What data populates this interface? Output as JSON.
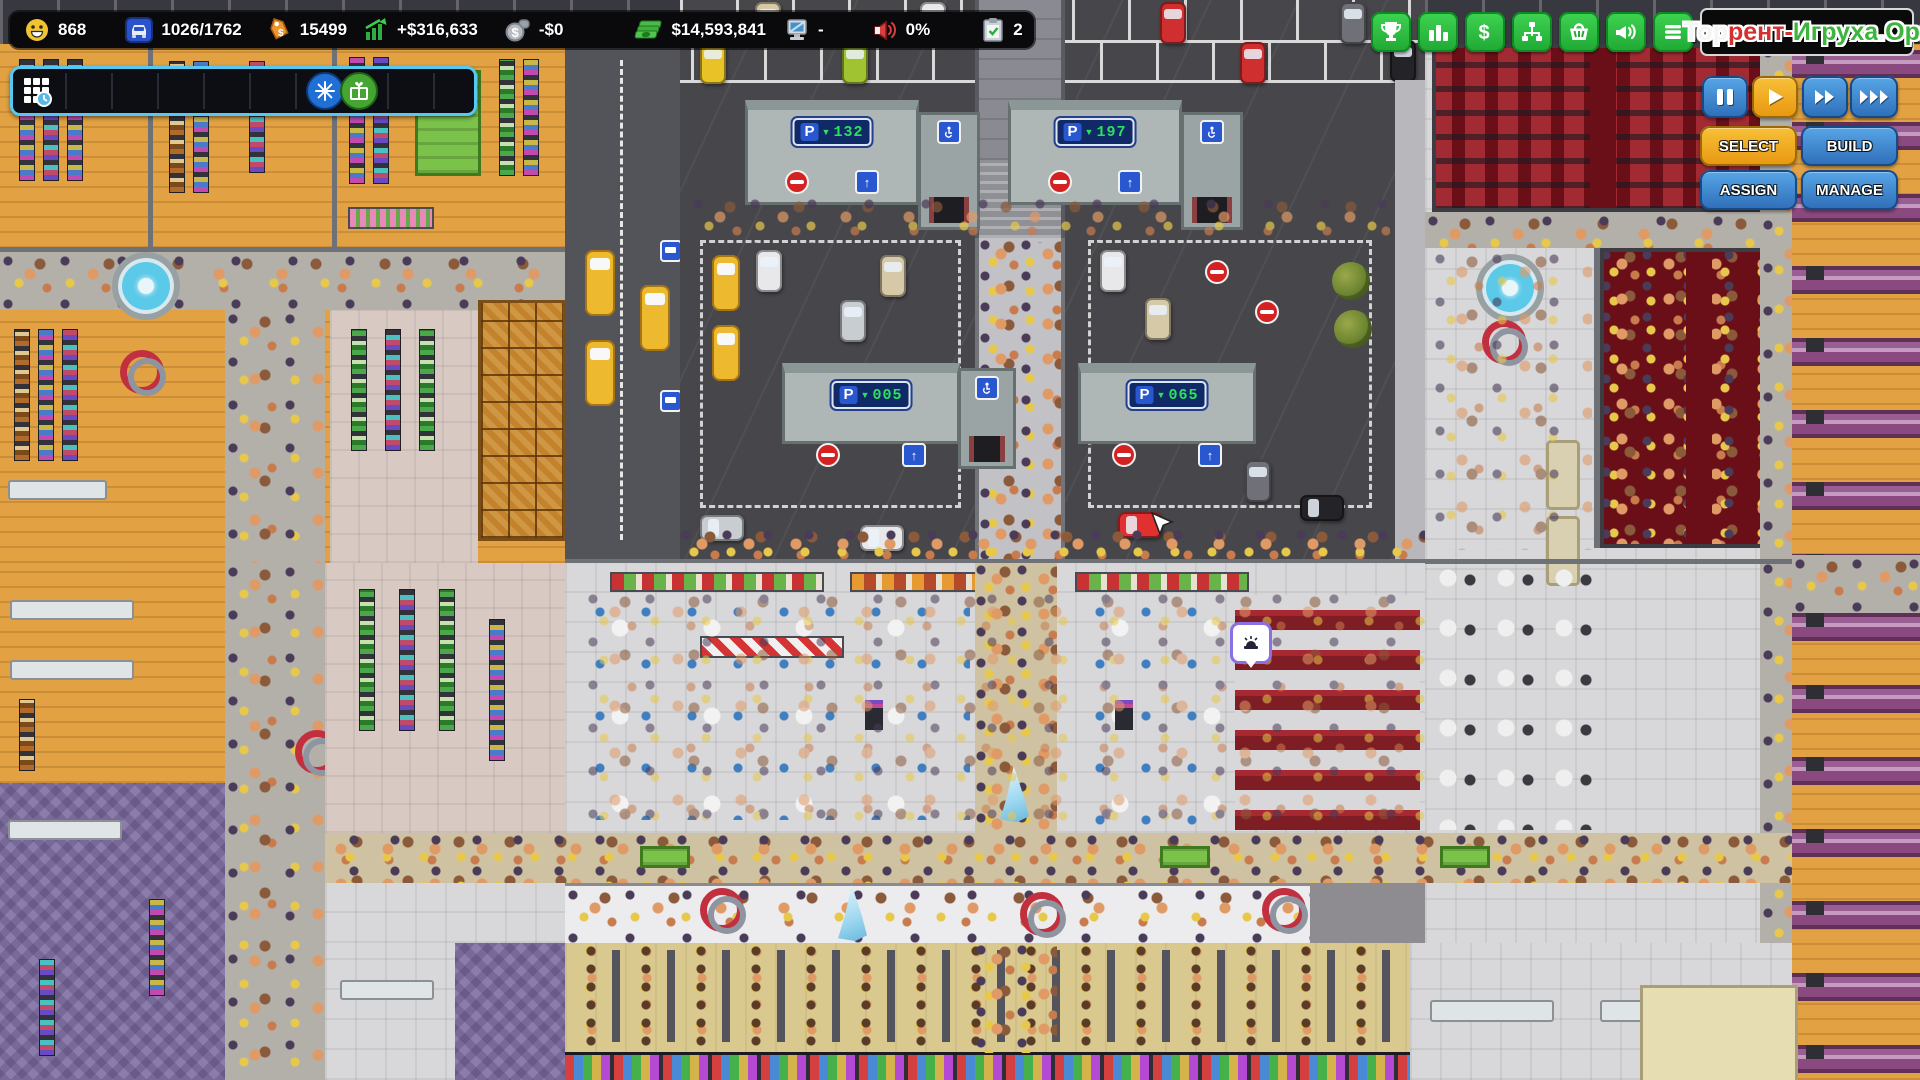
{
  "window": {
    "title": "Mall tycoon game",
    "width": 1920,
    "height": 1080
  },
  "topbar": {
    "stats": [
      {
        "name": "happiness",
        "icon": "smiley-icon",
        "value": "868"
      },
      {
        "name": "parking-usage",
        "icon": "car-icon",
        "value": "1026/1762"
      },
      {
        "name": "products",
        "icon": "price-tag-icon",
        "value": "15499"
      },
      {
        "name": "profit",
        "icon": "chart-up-icon",
        "value": "+$316,633"
      },
      {
        "name": "expenses",
        "icon": "money-bag-icon",
        "value": "-$0"
      },
      {
        "name": "cash",
        "icon": "cash-icon",
        "value": "$14,593,841"
      },
      {
        "name": "computers",
        "icon": "computer-icon",
        "value": "-"
      },
      {
        "name": "marketing",
        "icon": "megaphone-icon",
        "value": "0%"
      },
      {
        "name": "tasks",
        "icon": "clipboard-check-icon",
        "value": "2"
      }
    ]
  },
  "quickbar": {
    "slots": 10,
    "icons": [
      "calendar-clock-icon",
      "snowflake-icon",
      "gift-icon"
    ]
  },
  "menubar": {
    "buttons": [
      "achievements",
      "statistics",
      "finances",
      "staff",
      "products",
      "marketing",
      "menu"
    ]
  },
  "logo": {
    "segments": [
      {
        "text": "Тор",
        "color": "#f5f5f5"
      },
      {
        "text": "рент-",
        "color": "#d43030"
      },
      {
        "text": "Игруха",
        "color": "#3db53d"
      },
      {
        "text": ".",
        "color": "#f5f5f5"
      },
      {
        "text": "Орг",
        "color": "#3db53d"
      }
    ]
  },
  "playback": {
    "buttons": [
      {
        "name": "pause",
        "active": false
      },
      {
        "name": "play",
        "active": true
      },
      {
        "name": "fast-forward",
        "active": false
      },
      {
        "name": "fastest-forward",
        "active": false
      }
    ]
  },
  "mode_buttons": [
    {
      "label": "SELECT",
      "active": true
    },
    {
      "label": "BUILD",
      "active": false
    },
    {
      "label": "ASSIGN",
      "active": false
    },
    {
      "label": "MANAGE",
      "active": false
    }
  ],
  "parking": {
    "sign_prefix": "P",
    "arrow": "▼",
    "up_arrow": "↑",
    "signs": [
      {
        "id": "north-west",
        "spaces": "132"
      },
      {
        "id": "north-east",
        "spaces": "197"
      },
      {
        "id": "south-west",
        "spaces": "005"
      },
      {
        "id": "south-east",
        "spaces": "065"
      }
    ]
  },
  "colors": {
    "accent_blue": "#57c8f2",
    "button_green": "#2fcf46",
    "button_blue": "#3d8fd4",
    "button_yellow": "#f0a818",
    "sign_green": "#2ee060",
    "cinema_red": "#6a0f18",
    "mall_wood": "#e2a243"
  }
}
